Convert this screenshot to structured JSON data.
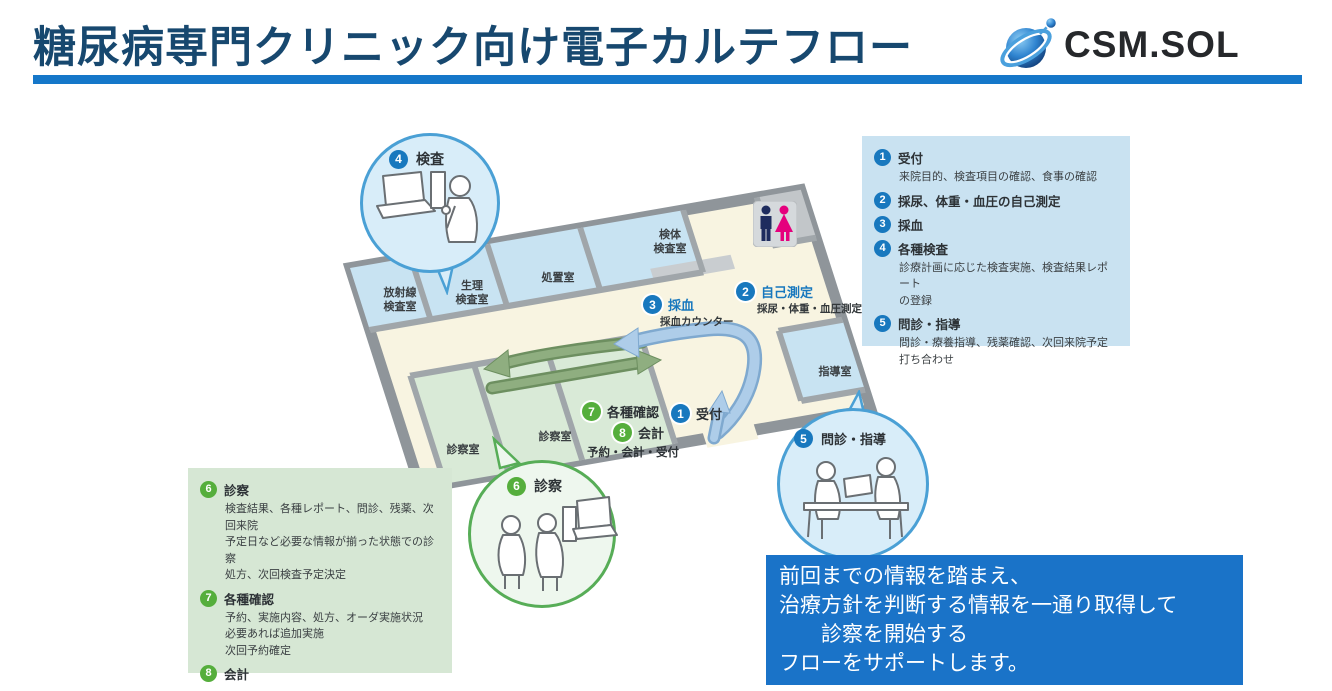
{
  "header": {
    "title": "糖尿病専門クリニック向け電子カルテフロー",
    "logo_text": "CSM.SOL"
  },
  "colors": {
    "title_navy": "#17486f",
    "accent_blue": "#1577c9",
    "badge_blue": "#1878be",
    "badge_green": "#55ae3c",
    "legend_blue_bg": "#c9e2f1",
    "legend_green_bg": "#d6e7d4",
    "message_bg": "#1a73c8",
    "floor_cream": "#f8f4e1",
    "room_blue": "#c8e3f2",
    "room_green": "#d9ead7"
  },
  "map": {
    "rooms": {
      "radiology": "放射線\n検査室",
      "physiology": "生理\n検査室",
      "treatment": "処置室",
      "specimen": "検体\n検査室",
      "guidance": "指導室",
      "exam1": "診察室",
      "exam2": "診察室",
      "reception_counter": "予約・会計・受付"
    },
    "steps": {
      "s1": {
        "num": "1",
        "label": "受付"
      },
      "s2": {
        "num": "2",
        "label": "自己測定",
        "sub": "採尿・体重・血圧測定"
      },
      "s3": {
        "num": "3",
        "label": "採血",
        "sub": "採血カウンター"
      },
      "s7": {
        "num": "7",
        "label": "各種確認"
      },
      "s8": {
        "num": "8",
        "label": "会計"
      }
    },
    "bubbles": {
      "b4": {
        "num": "4",
        "label": "検査"
      },
      "b5": {
        "num": "5",
        "label": "問診・指導"
      },
      "b6": {
        "num": "6",
        "label": "診察"
      }
    }
  },
  "legend_blue": {
    "items": [
      {
        "num": "1",
        "title": "受付",
        "desc": "来院目的、検査項目の確認、食事の確認"
      },
      {
        "num": "2",
        "title": "採尿、体重・血圧の自己測定",
        "desc": ""
      },
      {
        "num": "3",
        "title": "採血",
        "desc": ""
      },
      {
        "num": "4",
        "title": "各種検査",
        "desc": "診療計画に応じた検査実施、検査結果レポート\nの登録"
      },
      {
        "num": "5",
        "title": "問診・指導",
        "desc": "問診・療養指導、残薬確認、次回来院予定\n打ち合わせ"
      }
    ]
  },
  "legend_green": {
    "items": [
      {
        "num": "6",
        "title": "診察",
        "desc": "検査結果、各種レポート、問診、残薬、次回来院\n予定日など必要な情報が揃った状態での診察\n処方、次回検査予定決定"
      },
      {
        "num": "7",
        "title": "各種確認",
        "desc": "予約、実施内容、処方、オーダ実施状況\n必要あれば追加実施\n次回予約確定"
      },
      {
        "num": "8",
        "title": "会計",
        "desc": ""
      }
    ]
  },
  "message": {
    "lines": [
      "前回までの情報を踏まえ、",
      "治療方針を判断する情報を一通り取得して",
      "　　診察を開始する",
      "フローをサポートします。"
    ]
  }
}
